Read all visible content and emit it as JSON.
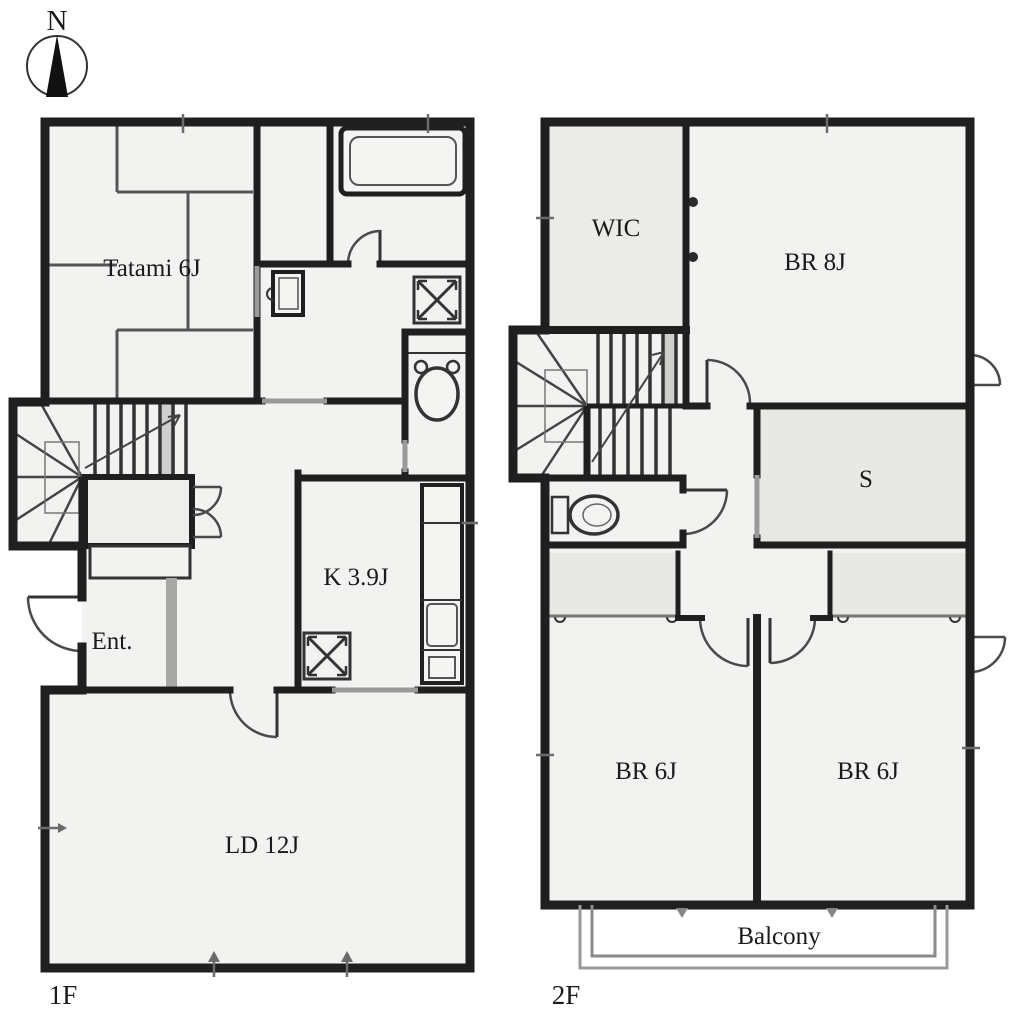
{
  "compass": {
    "north_label": "N"
  },
  "floor_1": {
    "floor_label": "1F",
    "rooms": {
      "tatami": {
        "label": "Tatami 6J"
      },
      "kitchen": {
        "label": "K 3.9J"
      },
      "entrance": {
        "label": "Ent."
      },
      "living_dining": {
        "label": "LD 12J"
      }
    }
  },
  "floor_2": {
    "floor_label": "2F",
    "rooms": {
      "walk_in_closet": {
        "label": "WIC"
      },
      "bedroom_8j": {
        "label": "BR 8J"
      },
      "storage": {
        "label": "S"
      },
      "bedroom_6j_left": {
        "label": "BR 6J"
      },
      "bedroom_6j_right": {
        "label": "BR 6J"
      },
      "balcony": {
        "label": "Balcony"
      }
    }
  },
  "colors": {
    "wall": "#1f1f1f",
    "room_fill": "#f2f2f0",
    "closet_fill": "#e8e8e5",
    "opening": "#9a9a9a",
    "door_arc": "#4a4a4a",
    "balcony_outline": "#8a8a8a"
  }
}
